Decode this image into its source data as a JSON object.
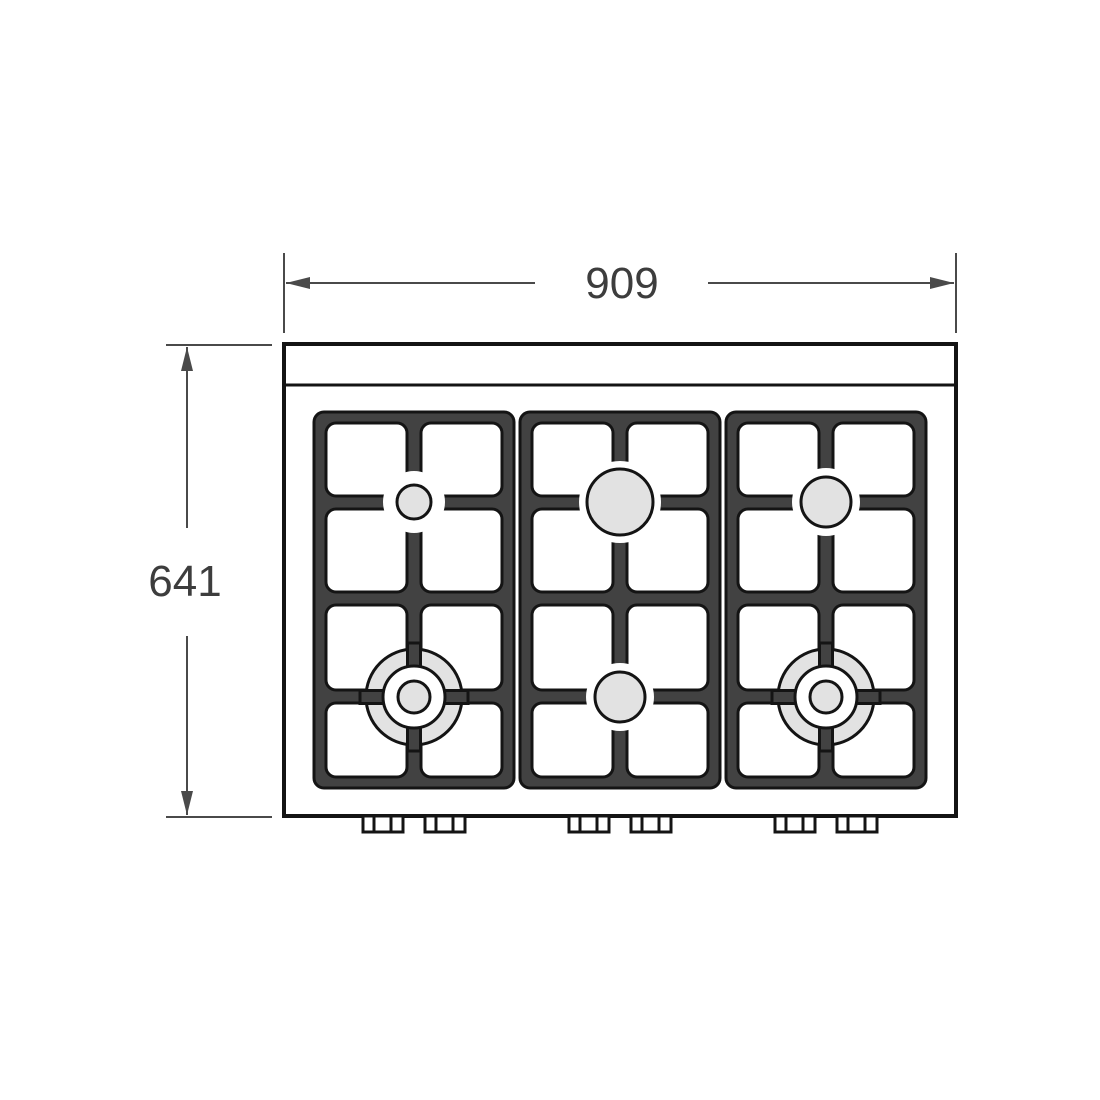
{
  "drawing": {
    "width_dimension_label": "909",
    "height_dimension_label": "641",
    "colors": {
      "dimension_line": "#4a4a4a",
      "dimension_text": "#3d3d3d",
      "grate_gray": "#424242",
      "burner_fill": "#e2e2e2",
      "outline_black": "#141414",
      "background": "#ffffff"
    },
    "burners": [
      {
        "position": "top-left",
        "shape": "small-burner"
      },
      {
        "position": "top-center",
        "shape": "large-burner"
      },
      {
        "position": "top-right",
        "shape": "medium-burner"
      },
      {
        "position": "bottom-left",
        "shape": "dual-ring-wok-burner"
      },
      {
        "position": "bottom-center",
        "shape": "medium-burner"
      },
      {
        "position": "bottom-right",
        "shape": "dual-ring-wok-burner"
      }
    ]
  }
}
